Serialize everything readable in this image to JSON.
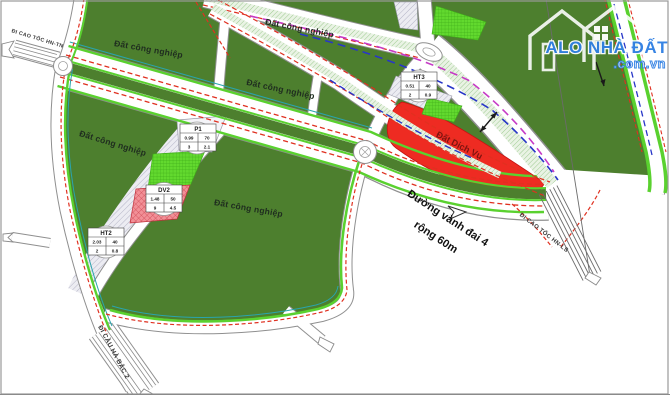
{
  "map": {
    "region_labels": {
      "industrial": "Đất công nghiệp",
      "service": "Đất Dịch Vụ"
    },
    "road_labels": {
      "ring_road_name": "Đường vành đai 4",
      "ring_road_width": "rộng 60m",
      "highway_hntn": "ĐI CAO TỐC HN-TN",
      "highway_hnls": "ĐI CAO TỐC HN-LS",
      "bridge_habac": "ĐI CẦU HÀ BẮC 2"
    },
    "parcel_tables": [
      {
        "id": "P1",
        "area": "0.99",
        "density": "70",
        "floors": "3",
        "coef": "2.1"
      },
      {
        "id": "DV2",
        "area": "1.48",
        "density": "50",
        "floors": "9",
        "coef": "4.5"
      },
      {
        "id": "HT2",
        "area": "2.03",
        "density": "40",
        "floors": "2",
        "coef": "0.8"
      },
      {
        "id": "HT3",
        "area": "0.51",
        "density": "40",
        "floors": "2",
        "coef": "0.9"
      }
    ],
    "logo": {
      "title": "ALO NHÀ ĐẤT",
      "domain": ".com.vn"
    },
    "colors": {
      "industrial_green": "#4d7f2e",
      "service_red": "#ee2b22",
      "verge_lime": "#5ad12f",
      "boundary_red_dash": "#e03020",
      "artery_magenta_dash": "#c63bc6",
      "artery_blue_dash": "#2836c8",
      "logo_blue": "#2f7fe3"
    }
  }
}
